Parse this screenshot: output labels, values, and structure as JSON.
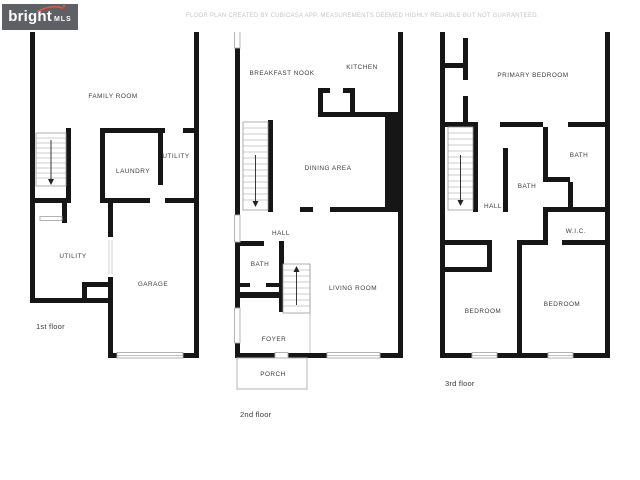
{
  "document_type": "floor-plan-sheet",
  "floors": [
    {
      "label": "1st floor",
      "rooms": [
        {
          "name": "FAMILY ROOM"
        },
        {
          "name": "LAUNDRY"
        },
        {
          "name": "UTILITY"
        },
        {
          "name": "UTILITY"
        },
        {
          "name": "GARAGE"
        }
      ]
    },
    {
      "label": "2nd floor",
      "rooms": [
        {
          "name": "BREAKFAST NOOK"
        },
        {
          "name": "KITCHEN"
        },
        {
          "name": "DINING AREA"
        },
        {
          "name": "HALL"
        },
        {
          "name": "BATH"
        },
        {
          "name": "LIVING ROOM"
        },
        {
          "name": "FOYER"
        },
        {
          "name": "PORCH"
        }
      ]
    },
    {
      "label": "3rd floor",
      "rooms": [
        {
          "name": "PRIMARY BEDROOM"
        },
        {
          "name": "BATH"
        },
        {
          "name": "BATH"
        },
        {
          "name": "HALL"
        },
        {
          "name": "W.I.C."
        },
        {
          "name": "BEDROOM"
        },
        {
          "name": "BEDROOM"
        }
      ]
    }
  ],
  "footer": {
    "logo_text": "bright",
    "logo_suffix": "MLS",
    "disclaimer": "FLOOR PLAN CREATED BY CUBICASA APP. MEASUREMENTS DEEMED HIGHLY RELIABLE BUT NOT GUARANTEED."
  },
  "colors": {
    "wall": "#161616",
    "window_frame": "#ababab",
    "room_label": "#3d3d3d",
    "logo_background": "#5d6165",
    "logo_accent": "#e8552f",
    "disclaimer_text": "#c6c6c6",
    "page_background": "#ffffff"
  }
}
